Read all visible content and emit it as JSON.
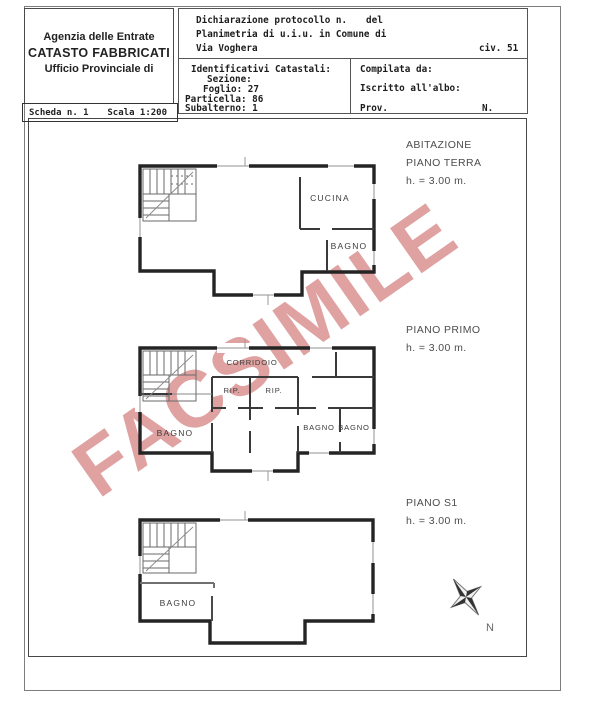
{
  "header": {
    "agency": {
      "line1": "Agenzia delle Entrate",
      "line2": "CATASTO FABBRICATI",
      "line3": "Ufficio Provinciale di"
    },
    "scheda": {
      "number": "Scheda n. 1",
      "scale": "Scala 1:200"
    },
    "protocol": {
      "declaration": "Dichiarazione protocollo n.",
      "del": "del",
      "planimetria": "Planimetria di u.i.u. in Comune di",
      "street": "Via Voghera",
      "civic": "civ. 51"
    },
    "cadastral": {
      "title": "Identificativi Catastali:",
      "sezione": "Sezione:",
      "foglio": "Foglio: 27",
      "particella": "Particella: 86",
      "subalterno": "Subalterno: 1"
    },
    "compiler": {
      "compilata": "Compilata da:",
      "iscritto": "Iscritto all'albo:",
      "prov": "Prov.",
      "n": "N."
    }
  },
  "plans": {
    "terra": {
      "building": "ABITAZIONE",
      "title": "PIANO TERRA",
      "height": "h. = 3.00 m.",
      "rooms": {
        "cucina": "CUCINA",
        "bagno": "BAGNO"
      }
    },
    "primo": {
      "title": "PIANO PRIMO",
      "height": "h. = 3.00 m.",
      "rooms": {
        "corridoio": "CORRIDOIO",
        "rip1": "RIP.",
        "rip2": "RIP.",
        "bagno_left": "BAGNO",
        "bagno_mid": "BAGNO",
        "bagno_right": "BAGNO"
      }
    },
    "s1": {
      "title": "PIANO S1",
      "height": "h. = 3.00 m.",
      "rooms": {
        "bagno": "BAGNO"
      }
    }
  },
  "watermark": {
    "text": "FACSIMILE",
    "color": "#dc9595"
  },
  "compass": {
    "north": "N"
  }
}
